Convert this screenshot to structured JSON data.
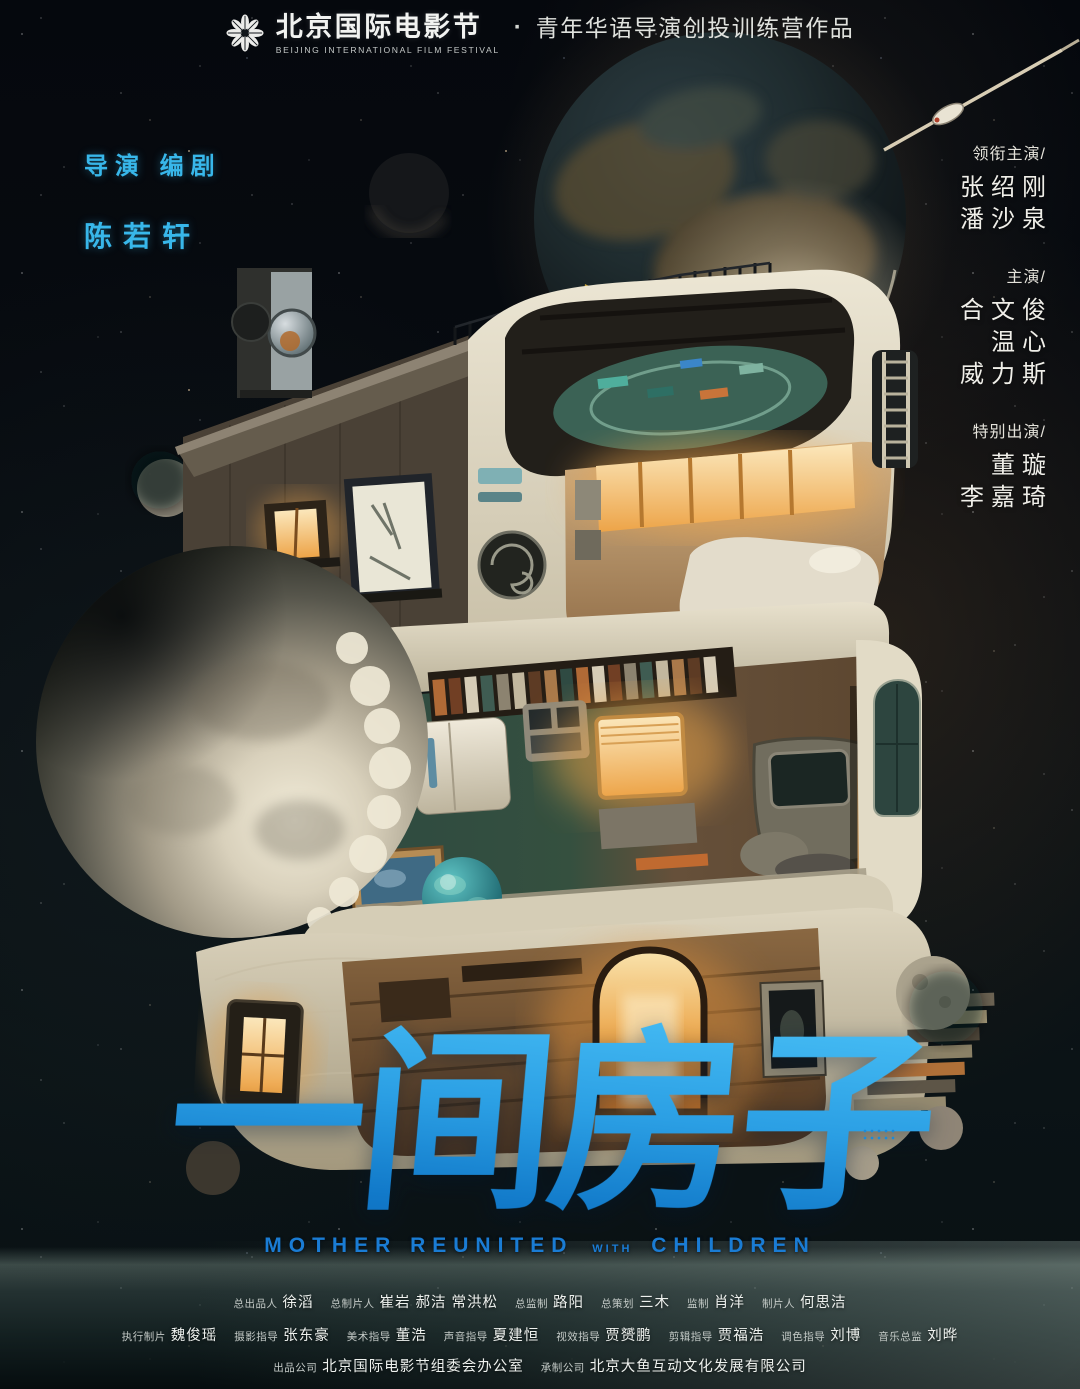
{
  "festival": {
    "logo": "bjiff-snowflake-logo",
    "name_cn": "北京国际电影节",
    "name_en": "BEIJING INTERNATIONAL FILM FESTIVAL",
    "separator": "·",
    "program": "青年华语导演创投训练营作品"
  },
  "director": {
    "roles": "导演 编剧",
    "name": "陈若轩"
  },
  "cast": {
    "groups": [
      {
        "role": "领衔主演/",
        "names": [
          "张绍刚",
          "潘沙泉"
        ]
      },
      {
        "role": "主演/",
        "names": [
          "合文俊",
          "温心",
          "威力斯"
        ]
      },
      {
        "role": "特别出演/",
        "names": [
          "董璇",
          "李嘉琦"
        ]
      }
    ]
  },
  "title": {
    "cn": "一间房子",
    "en": {
      "part1": "MOTHER REUNITED",
      "part2": "WITH",
      "part3": "CHILDREN"
    }
  },
  "credits": {
    "line1": [
      {
        "label": "总出品人",
        "name": "徐滔"
      },
      {
        "label": "总制片人",
        "name": "崔岩 郝洁 常洪松"
      },
      {
        "label": "总监制",
        "name": "路阳"
      },
      {
        "label": "总策划",
        "name": "三木"
      },
      {
        "label": "监制",
        "name": "肖洋"
      },
      {
        "label": "制片人",
        "name": "何思洁"
      }
    ],
    "line2": [
      {
        "label": "执行制片",
        "name": "魏俊瑶"
      },
      {
        "label": "摄影指导",
        "name": "张东豪"
      },
      {
        "label": "美术指导",
        "name": "董浩"
      },
      {
        "label": "声音指导",
        "name": "夏建恒"
      },
      {
        "label": "视效指导",
        "name": "贾赟鹏"
      },
      {
        "label": "剪辑指导",
        "name": "贾福浩"
      },
      {
        "label": "调色指导",
        "name": "刘博"
      },
      {
        "label": "音乐总监",
        "name": "刘晔"
      }
    ],
    "line3": [
      {
        "label": "出品公司",
        "name": "北京国际电影节组委会办公室"
      },
      {
        "label": "承制公司",
        "name": "北京大鱼互动文化发展有限公司"
      }
    ]
  },
  "colors": {
    "accent_cyan": "#38b7ea",
    "title_blue_top": "#49c0f6",
    "title_blue_bottom": "#0d6bbd",
    "subtitle_blue": "#1a7cd4",
    "window_glow": "#efa94e"
  }
}
